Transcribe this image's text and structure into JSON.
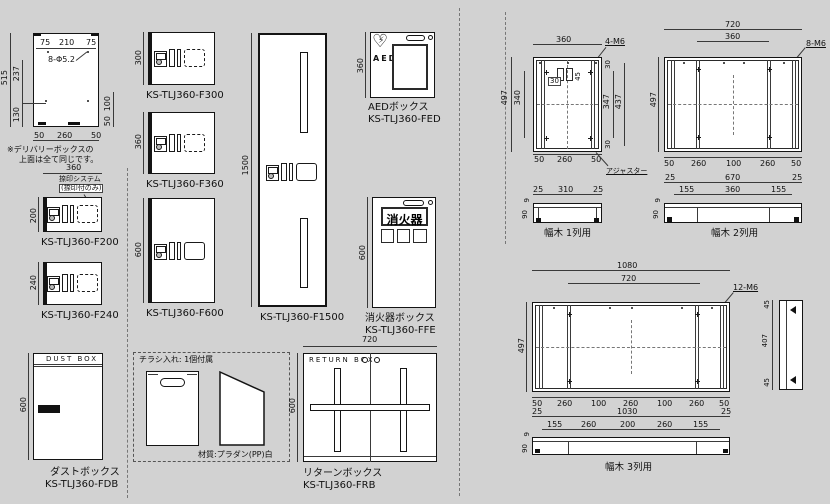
{
  "page": {
    "bg": "#d2d2d2",
    "line": "#1a1a1a"
  },
  "topview": {
    "d75l": "75",
    "d210": "210",
    "d75r": "75",
    "holes": "8-Φ5.2",
    "d515": "515",
    "d237": "237",
    "d130": "130",
    "d100": "100",
    "d50r": "50",
    "b50l": "50",
    "b260": "260",
    "b50r": "50",
    "note1": "※デリバリーボックスの",
    "note2": "上面は全て同じです。"
  },
  "lockers": {
    "f200": {
      "model": "KS-TLJ360-F200",
      "w": "360",
      "h": "200",
      "stamp1": "捺印システム",
      "stamp2": "(捺印付のみ)"
    },
    "f240": {
      "model": "KS-TLJ360-F240",
      "h": "240"
    },
    "f300": {
      "model": "KS-TLJ360-F300",
      "h": "300"
    },
    "f360": {
      "model": "KS-TLJ360-F360",
      "h": "360"
    },
    "f600": {
      "model": "KS-TLJ360-F600",
      "h": "600"
    },
    "f1500": {
      "model": "KS-TLJ360-F1500",
      "h": "1500"
    }
  },
  "aed": {
    "name": "AEDボックス",
    "model": "KS-TLJ360-FED",
    "h": "360",
    "sign": "AED"
  },
  "fire": {
    "name": "消火器ボックス",
    "model": "KS-TLJ360-FFE",
    "h": "600",
    "sign": "消火器"
  },
  "dust": {
    "name": "ダストボックス",
    "model": "KS-TLJ360-FDB",
    "h": "600",
    "header": "DUST BOX"
  },
  "flyer": {
    "title": "チラシ入れ: 1個付属",
    "material": "材質:プラダン(PP)白"
  },
  "ret": {
    "name": "リターンボックス",
    "model": "KS-TLJ360-FRB",
    "w": "720",
    "h": "600",
    "header": "RETURN BOX"
  },
  "p1": {
    "label": "幅木 1列用",
    "w": "360",
    "bolt": "4-M6",
    "h": "497",
    "ih": "340",
    "t30": "30",
    "i30": "30",
    "i45": "45",
    "r347": "347",
    "r437": "437",
    "b30": "30",
    "b": [
      "50",
      "260",
      "50"
    ],
    "adjuster": "アジャスター",
    "s": [
      "25",
      "310",
      "25"
    ],
    "s9": "9",
    "s90": "90"
  },
  "p2": {
    "label": "幅木 2列用",
    "w": "720",
    "iw": "360",
    "bolt": "8-M6",
    "h": "497",
    "b": [
      "50",
      "260",
      "100",
      "260",
      "50"
    ],
    "s1": [
      "25",
      "670",
      "25"
    ],
    "s2": [
      "155",
      "360",
      "155"
    ],
    "s9": "9",
    "s90": "90"
  },
  "p3": {
    "label": "幅木 3列用",
    "w": "1080",
    "iw": "720",
    "bolt": "12-M6",
    "h": "497",
    "b": [
      "50",
      "260",
      "100",
      "260",
      "100",
      "260",
      "50"
    ],
    "pr": [
      "45",
      "407",
      "45"
    ],
    "s1": [
      "25",
      "1030",
      "25"
    ],
    "s2": [
      "155",
      "260",
      "200",
      "260",
      "155"
    ],
    "s9": "9",
    "s90": "90"
  }
}
